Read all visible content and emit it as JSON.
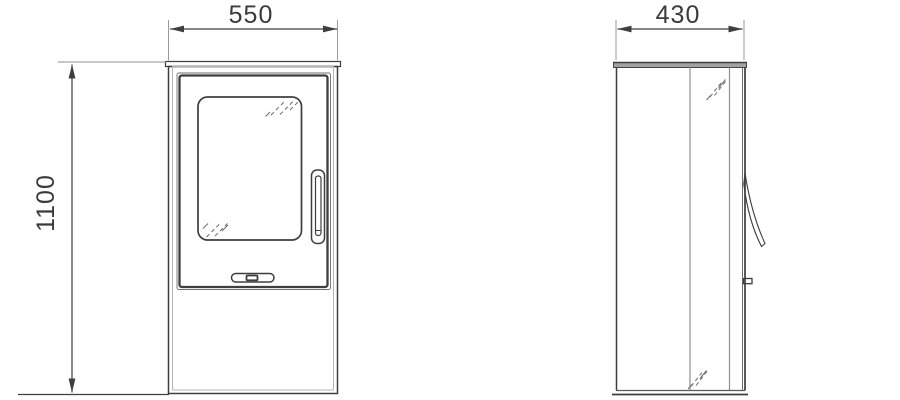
{
  "drawing": {
    "front_view": {
      "width": "550",
      "height": "1100"
    },
    "side_view": {
      "depth": "430"
    },
    "colors": {
      "line": "#3e3e3e",
      "secondary_line": "#8f8f8f",
      "plate_fill": "#a2a2a2",
      "background": "#ffffff"
    }
  }
}
